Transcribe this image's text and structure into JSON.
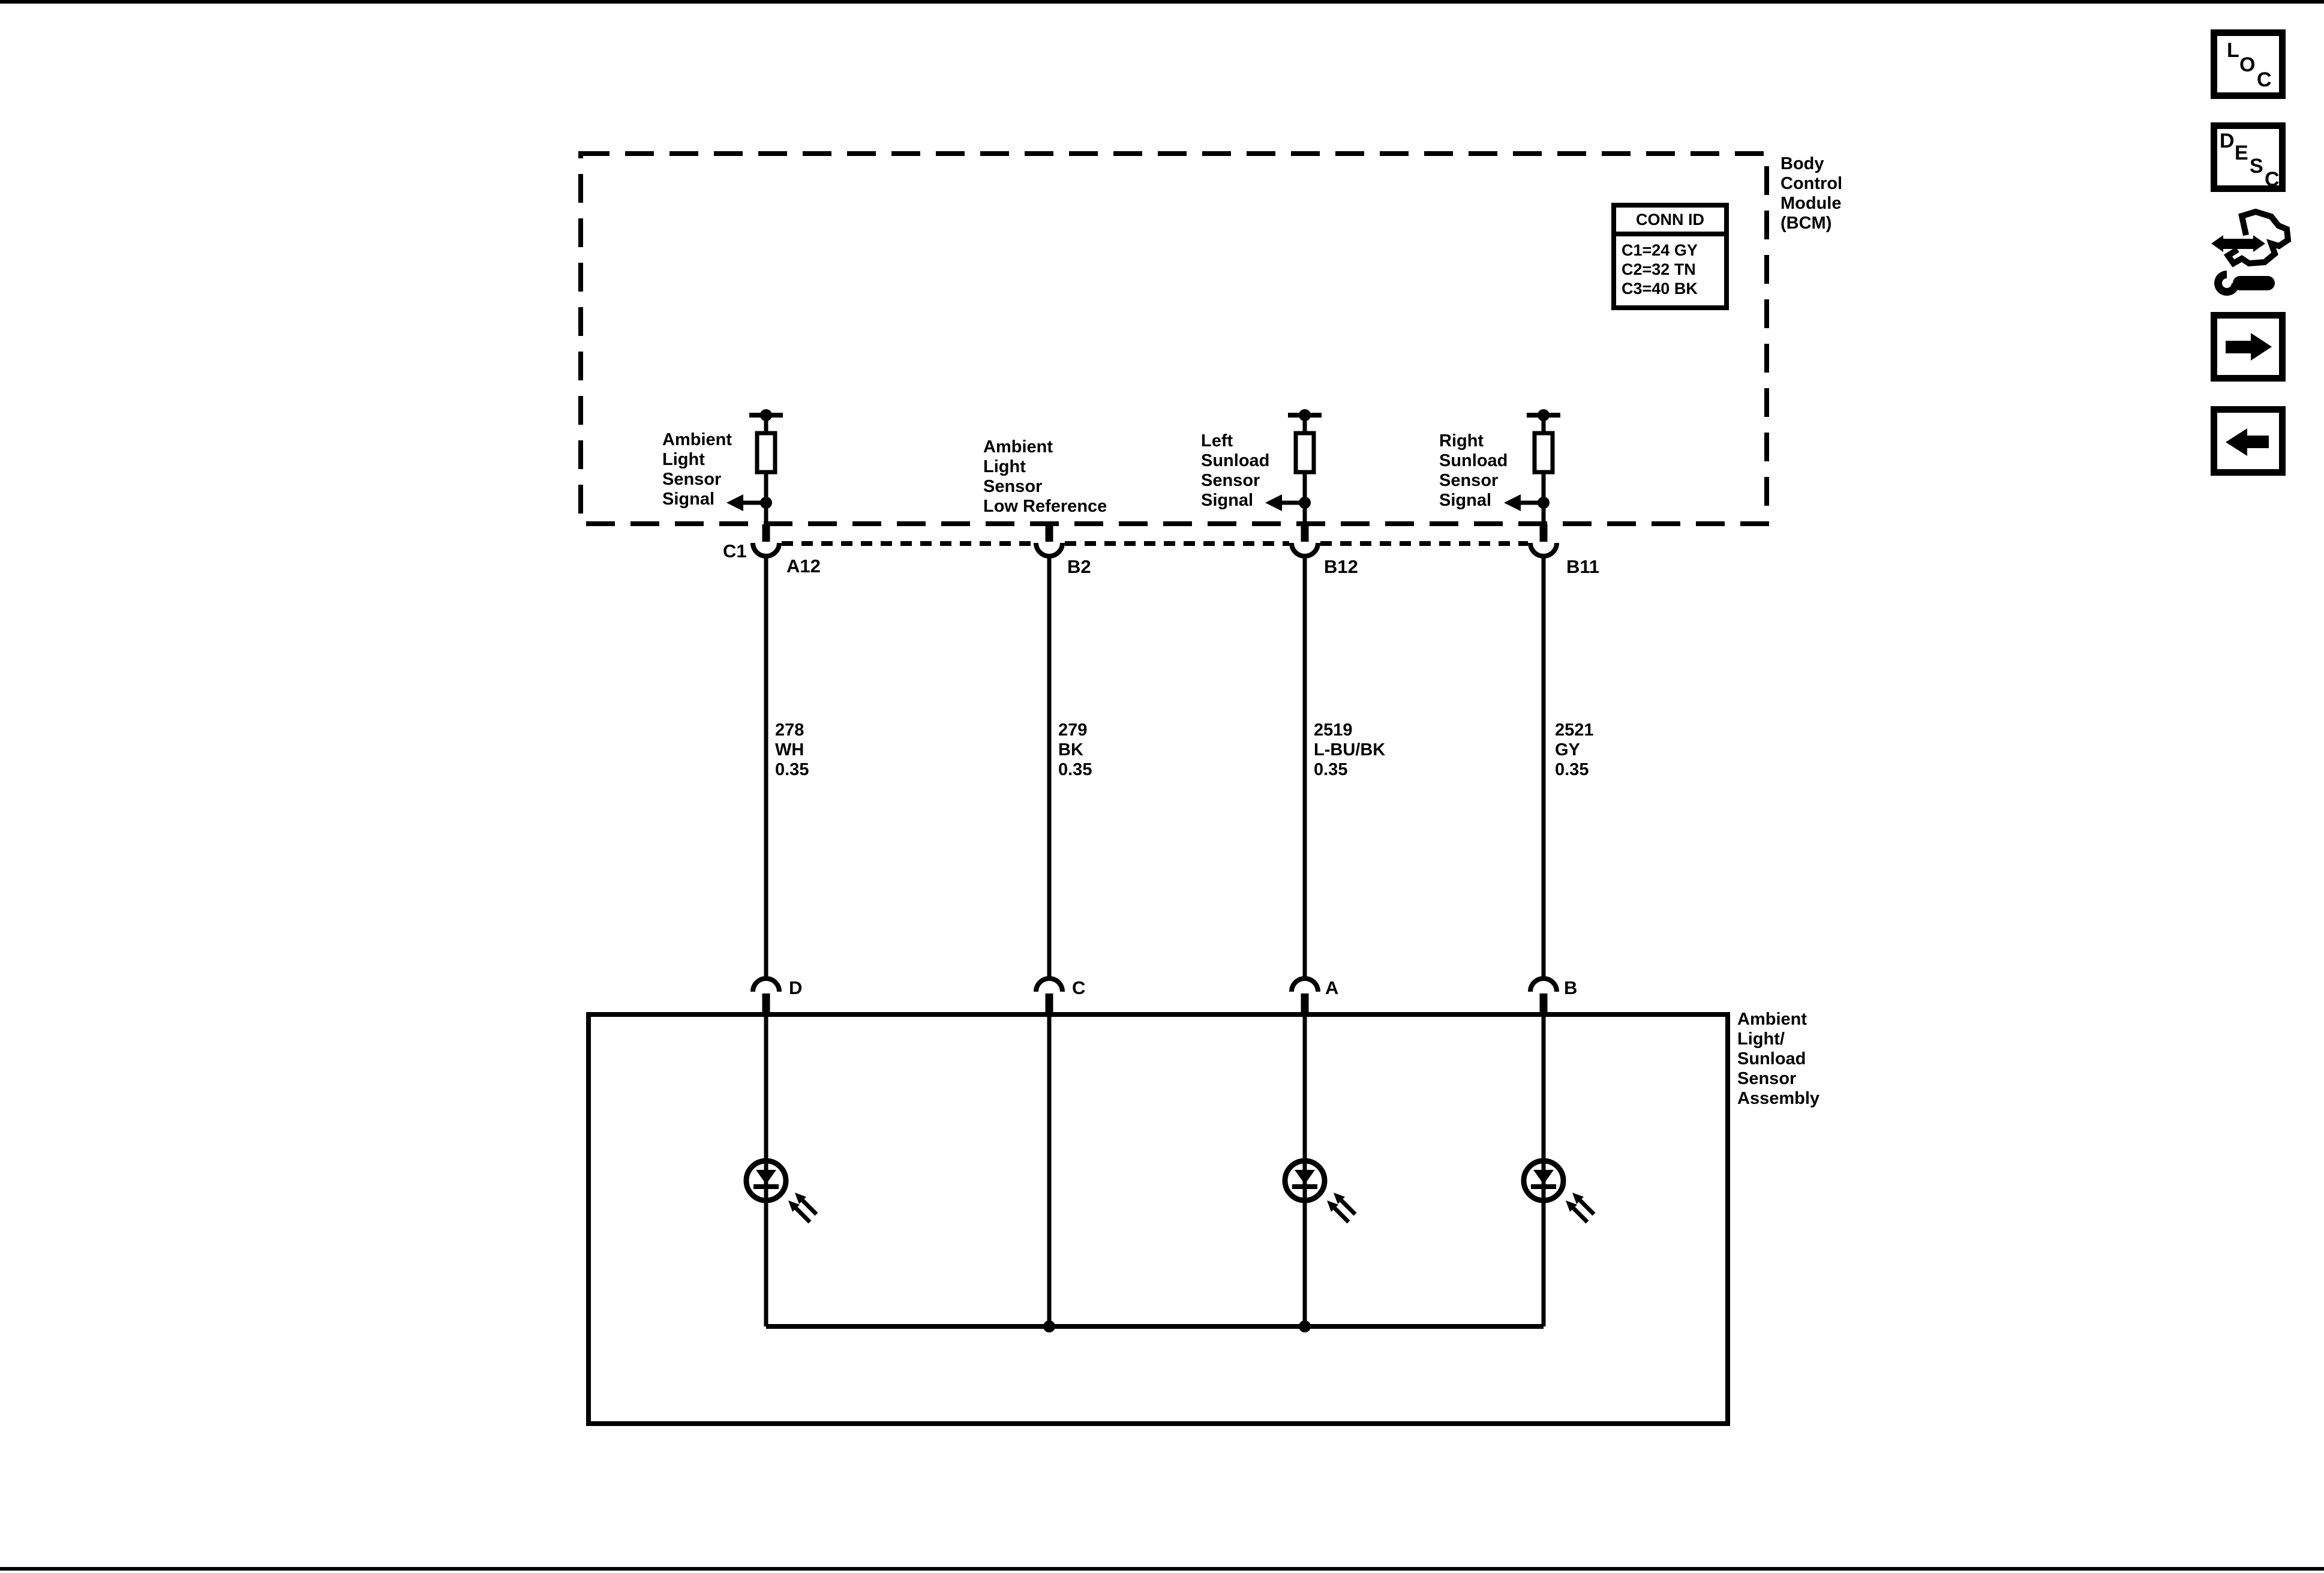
{
  "diagram": {
    "bcm_label": "Body\nControl\nModule\n(BCM)",
    "conn_id": {
      "title": "CONN ID",
      "rows": [
        "C1=24 GY",
        "C2=32 TN",
        "C3=40 BK"
      ]
    },
    "connector_label": "C1",
    "branches": [
      {
        "label": "Ambient\nLight\nSensor\nSignal",
        "pin_top": "A12",
        "wire": "278\nWH\n0.35",
        "pin_bottom": "D"
      },
      {
        "label": "Ambient\nLight\nSensor\nLow Reference",
        "pin_top": "B2",
        "wire": "279\nBK\n0.35",
        "pin_bottom": "C"
      },
      {
        "label": "Left\nSunload\nSensor\nSignal",
        "pin_top": "B12",
        "wire": "2519\nL-BU/BK\n0.35",
        "pin_bottom": "A"
      },
      {
        "label": "Right\nSunload\nSensor\nSignal",
        "pin_top": "B11",
        "wire": "2521\nGY\n0.35",
        "pin_bottom": "B"
      }
    ],
    "assembly_label": "Ambient\nLight/\nSunload\nSensor\nAssembly"
  },
  "nav": {
    "loc": [
      "L",
      "O",
      "C"
    ],
    "desc": [
      "D",
      "E",
      "S",
      "C"
    ]
  },
  "colors": {
    "ink": "#000000",
    "paper": "#ffffff"
  }
}
